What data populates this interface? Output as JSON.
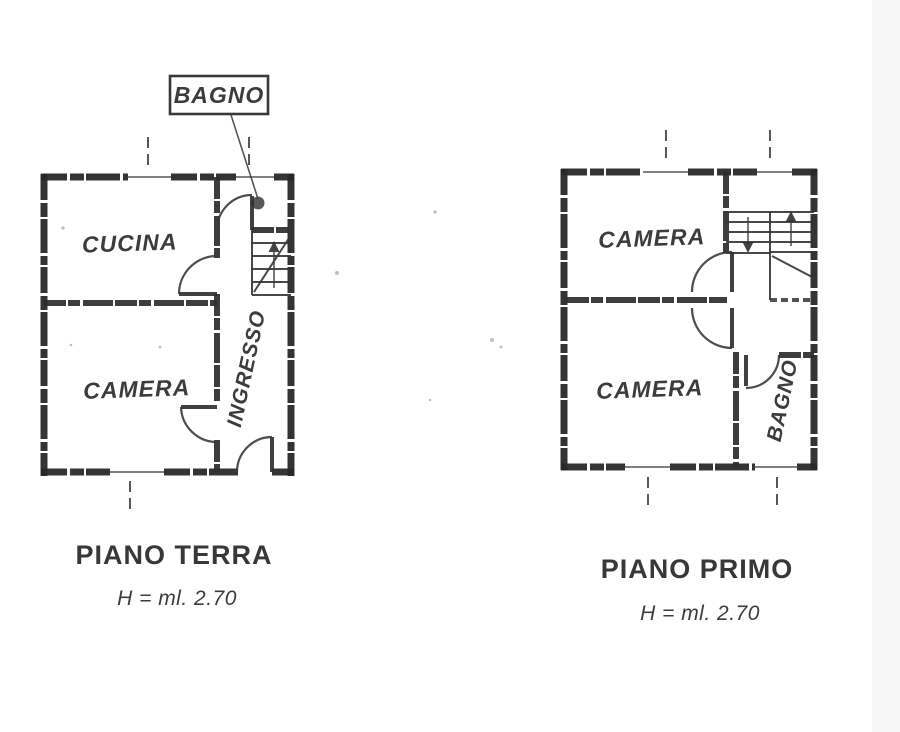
{
  "document": {
    "type": "scanned floor plan drawing",
    "background": "#ffffff",
    "ink_color": "#2b2b2b"
  },
  "plans": [
    {
      "title": "PIANO TERRA",
      "height_note": "H = ml. 2.70",
      "callout": {
        "label": "BAGNO"
      },
      "rooms": [
        {
          "name": "CUCINA"
        },
        {
          "name": "CAMERA"
        },
        {
          "name": "INGRESSO"
        }
      ],
      "stairs": {
        "direction": "up"
      }
    },
    {
      "title": "PIANO PRIMO",
      "height_note": "H = ml. 2.70",
      "rooms": [
        {
          "name": "CAMERA"
        },
        {
          "name": "CAMERA"
        },
        {
          "name": "BAGNO"
        }
      ],
      "stairs": {
        "direction": "up-down"
      }
    }
  ]
}
